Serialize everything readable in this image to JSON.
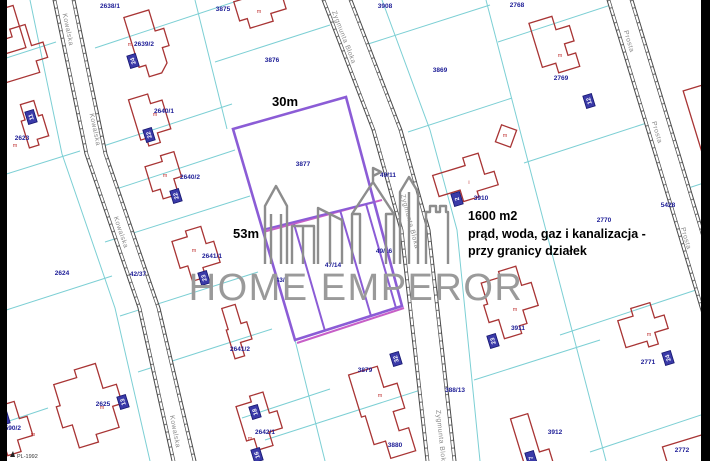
{
  "title": "Cadastral map - plot offer",
  "colors": {
    "parcel_line": "#7ccfd4",
    "building": "#a83434",
    "parcel_number": "#1c1c96",
    "plot_outline": "#8b5cd6",
    "plot_inner_magenta": "#c75fc7",
    "road_line": "#4a4a4a",
    "watermark": "#9a9a9a",
    "plate_fill": "#3a3aa8",
    "frame_bar": "#010101"
  },
  "watermark": {
    "text": "HOME EMPEROR"
  },
  "annotations": {
    "width_label": "30m",
    "height_label": "53m",
    "info_lines": [
      "1600 m2",
      "prąd, woda, gaz i kanalizacja -",
      "przy granicy działek"
    ]
  },
  "legend": {
    "text": "PL-1992"
  },
  "streets": [
    {
      "name": "Kowalska",
      "labels": [
        [
          66,
          30,
          78
        ],
        [
          93,
          130,
          78
        ],
        [
          119,
          233,
          71
        ],
        [
          173,
          432,
          79
        ]
      ]
    },
    {
      "name": "Zygmunta Bloka",
      "labels": [
        [
          342,
          38,
          69
        ],
        [
          408,
          222,
          75
        ],
        [
          439,
          438,
          84
        ]
      ]
    },
    {
      "name": "Prosta",
      "labels": [
        [
          627,
          42,
          73
        ],
        [
          655,
          133,
          73
        ],
        [
          684,
          239,
          73
        ]
      ]
    }
  ],
  "parcel_labels": [
    [
      "2638/1",
      110,
      8
    ],
    [
      "3875",
      223,
      11
    ],
    [
      "3908",
      385,
      8
    ],
    [
      "2768",
      517,
      7
    ],
    [
      "2639/2",
      144,
      46
    ],
    [
      "3876",
      272,
      62
    ],
    [
      "3869",
      440,
      72
    ],
    [
      "2769",
      561,
      80
    ],
    [
      "2640/1",
      164,
      113
    ],
    [
      "2623",
      22,
      140
    ],
    [
      "3877",
      303,
      166
    ],
    [
      "49/11",
      388,
      177
    ],
    [
      "2640/2",
      190,
      179
    ],
    [
      "3910",
      481,
      200
    ],
    [
      "5428",
      668,
      207
    ],
    [
      "2770",
      604,
      222
    ],
    [
      "2641/1",
      212,
      258
    ],
    [
      "2624",
      62,
      275
    ],
    [
      "42/37",
      138,
      276
    ],
    [
      "47/14",
      333,
      267
    ],
    [
      "49/16",
      384,
      253
    ],
    [
      "43/1",
      282,
      282
    ],
    [
      "2641/2",
      240,
      351
    ],
    [
      "3911",
      518,
      330
    ],
    [
      "2771",
      648,
      364
    ],
    [
      "3879",
      365,
      372
    ],
    [
      "388/13",
      455,
      392
    ],
    [
      "2625",
      103,
      406
    ],
    [
      "2590/2",
      11,
      430
    ],
    [
      "2642/1",
      265,
      434
    ],
    [
      "3880",
      395,
      447
    ],
    [
      "3912",
      555,
      434
    ],
    [
      "2772",
      682,
      452
    ]
  ],
  "address_plates": [
    [
      "24",
      133,
      61
    ],
    [
      "22",
      149,
      135
    ],
    [
      "11",
      31,
      117
    ],
    [
      "22",
      176,
      196
    ],
    [
      "23",
      204,
      278
    ],
    [
      "13",
      123,
      402
    ],
    [
      "9",
      4,
      418
    ],
    [
      "18",
      255,
      412
    ],
    [
      "16",
      257,
      455
    ],
    [
      "32",
      396,
      359
    ],
    [
      "23",
      493,
      341
    ],
    [
      "24",
      668,
      358
    ],
    [
      "12",
      589,
      101
    ],
    [
      "2",
      457,
      199
    ],
    [
      "7",
      531,
      458
    ]
  ],
  "building_letters": [
    [
      "m",
      130,
      46
    ],
    [
      "m",
      155,
      116
    ],
    [
      "m",
      165,
      177
    ],
    [
      "m",
      194,
      252
    ],
    [
      "m",
      250,
      440
    ],
    [
      "m",
      102,
      409
    ],
    [
      "m",
      33,
      436
    ],
    [
      "m",
      259,
      13
    ],
    [
      "m",
      560,
      57
    ],
    [
      "m",
      505,
      137
    ],
    [
      "m",
      649,
      336
    ],
    [
      "m",
      515,
      311
    ],
    [
      "m",
      380,
      397
    ],
    [
      "i",
      469,
      184
    ],
    [
      "m",
      15,
      147
    ]
  ],
  "buildings": [
    {
      "x": 148,
      "y": 52,
      "r": -17,
      "p": "M-13,-40 h26 v22 h9 v18 h-7 v16 l-8,8 h-13 v-12 h-7 v-24 z"
    },
    {
      "x": 30,
      "y": 68,
      "r": -17,
      "p": "M-30,-35 h22 v-8 h16 v22 h12 v16 h-12 v12 h-38 z"
    },
    {
      "x": 152,
      "y": 122,
      "r": -17,
      "p": "M-16,-28 h20 v10 h12 v30 h-14 v10 h-12 v-8 h-6 z"
    },
    {
      "x": 36,
      "y": 125,
      "r": -17,
      "p": "M-9,-24 h14 v16 h4 v22 h-12 v6 h-10 v-28 h4 z"
    },
    {
      "x": 170,
      "y": 180,
      "r": -17,
      "p": "M-20,-20 h18 v-6 h14 v26 h-8 v16 h-16 v-10 h-8 z"
    },
    {
      "x": 200,
      "y": 258,
      "r": -17,
      "p": "M-22,-24 h16 v-6 h16 v18 h8 v22 h-18 v10 h-14 v-16 h-8 z"
    },
    {
      "x": 237,
      "y": 331,
      "r": -17,
      "p": "M-8,-26 h14 v20 h6 v18 h-12 v14 h-10 v-30 h2 z"
    },
    {
      "x": 262,
      "y": 430,
      "r": -17,
      "p": "M-18,-30 h16 v-6 h14 v22 h8 v18 h-14 v14 h-16 v-12 h-8 v-22 z"
    },
    {
      "x": 100,
      "y": 406,
      "r": -17,
      "p": "M-38,-34 h24 v-8 h22 v26 h14 v20 h-10 v22 h-24 v8 h-20 v-24 h-10 v-22 h4 z"
    },
    {
      "x": 16,
      "y": 428,
      "r": -17,
      "p": "M-14,-26 h20 v18 h8 v20 h-16 v12 h-14 v-30 h2 z"
    },
    {
      "x": 262,
      "y": 12,
      "r": -17,
      "p": "M-24,-18 h18 v-8 h20 v16 h10 v14 h-16 v8 h-24 v-10 h-8 z"
    },
    {
      "x": 558,
      "y": 50,
      "r": -17,
      "p": "M-20,-34 h24 v14 h14 v16 h-10 v12 h8 v14 h-22 v-10 h-14 v-24 z"
    },
    {
      "x": 506,
      "y": 136,
      "r": 20,
      "p": "M-8,-9 h16 v18 h-16 z"
    },
    {
      "x": 466,
      "y": 182,
      "r": -17,
      "p": "M-30,-16 h34 v-8 h16 v22 h10 v14 h-22 v6 h-16 v-12 h-22 z"
    },
    {
      "x": 704,
      "y": 118,
      "r": -17,
      "p": "M-12,-32 h24 v64 h-24 z"
    },
    {
      "x": 646,
      "y": 331,
      "r": -17,
      "p": "M-24,-18 h16 v-8 h20 v16 h10 v14 h-14 v12 h-10 v-6 h-22 z"
    },
    {
      "x": 516,
      "y": 308,
      "r": -17,
      "p": "M-26,-34 h20 v-6 h18 v20 h10 v24 h-16 v14 h-8 v8 h-18 v-20 h-10 v-18 h4 z"
    },
    {
      "x": 534,
      "y": 441,
      "r": -17,
      "p": "M-16,-28 h18 v40 h10 v20 h-28 z"
    },
    {
      "x": 687,
      "y": 452,
      "r": -17,
      "p": "M-22,-12 h44 v26 h-44 z"
    },
    {
      "x": 385,
      "y": 412,
      "r": -17,
      "p": "M-24,-46 h30 v22 h14 v26 h-12 v20 h10 v24 h-26 v-18 h-12 v-30 h-4 v-22 z"
    },
    {
      "x": 8,
      "y": 30,
      "r": -17,
      "p": "M-12,-22 h24 v44 h-24 z"
    }
  ],
  "boundaries": [
    [
      0,
      60,
      56,
      42
    ],
    [
      0,
      176,
      80,
      151
    ],
    [
      0,
      312,
      112,
      276
    ],
    [
      0,
      424,
      48,
      408
    ],
    [
      95,
      48,
      240,
      0
    ],
    [
      85,
      152,
      232,
      104
    ],
    [
      98,
      195,
      235,
      150
    ],
    [
      105,
      242,
      250,
      196
    ],
    [
      120,
      316,
      258,
      272
    ],
    [
      138,
      372,
      272,
      329
    ],
    [
      242,
      418,
      330,
      389
    ],
    [
      215,
      62,
      330,
      25
    ],
    [
      265,
      440,
      430,
      387
    ],
    [
      486,
      0,
      606,
      461
    ],
    [
      365,
      45,
      490,
      5
    ],
    [
      408,
      132,
      512,
      98
    ],
    [
      498,
      42,
      626,
      0
    ],
    [
      524,
      163,
      662,
      118
    ],
    [
      560,
      335,
      702,
      288
    ],
    [
      474,
      380,
      600,
      340
    ],
    [
      590,
      452,
      710,
      412
    ],
    [
      676,
      192,
      710,
      181
    ]
  ],
  "boundary_polylines": [
    [
      [
        30,
        0
      ],
      [
        62,
        154
      ],
      [
        115,
        308
      ],
      [
        150,
        461
      ]
    ],
    [
      [
        195,
        0
      ],
      [
        227,
        129
      ]
    ],
    [
      [
        295,
        340
      ],
      [
        325,
        461
      ]
    ],
    [
      [
        382,
        0
      ],
      [
        430,
        130
      ],
      [
        457,
        230
      ],
      [
        480,
        461
      ]
    ]
  ],
  "roads": [
    {
      "fill": [
        [
          53,
          0
        ],
        [
          85,
          154
        ],
        [
          138,
          308
        ],
        [
          172,
          461
        ],
        [
          196,
          461
        ],
        [
          160,
          308
        ],
        [
          107,
          154
        ],
        [
          75,
          0
        ]
      ],
      "edges": [
        [
          [
            53,
            0
          ],
          [
            85,
            154
          ],
          [
            138,
            308
          ],
          [
            172,
            461
          ]
        ],
        [
          [
            56,
            0
          ],
          [
            88,
            154
          ],
          [
            141,
            308
          ],
          [
            175,
            461
          ]
        ],
        [
          [
            75,
            0
          ],
          [
            107,
            154
          ],
          [
            160,
            308
          ],
          [
            196,
            461
          ]
        ],
        [
          [
            72,
            0
          ],
          [
            104,
            154
          ],
          [
            157,
            308
          ],
          [
            193,
            461
          ]
        ]
      ],
      "ticks": [
        [
          [
            54.5,
            0
          ],
          [
            86.5,
            154
          ],
          [
            139.5,
            308
          ],
          [
            173.5,
            461
          ]
        ],
        [
          [
            73.5,
            0
          ],
          [
            105.5,
            154
          ],
          [
            158.5,
            308
          ],
          [
            194.5,
            461
          ]
        ]
      ]
    },
    {
      "fill": [
        [
          322,
          0
        ],
        [
          372,
          130
        ],
        [
          400,
          230
        ],
        [
          426,
          461
        ],
        [
          456,
          461
        ],
        [
          430,
          230
        ],
        [
          402,
          130
        ],
        [
          352,
          0
        ]
      ],
      "edges": [
        [
          [
            322,
            0
          ],
          [
            372,
            130
          ],
          [
            400,
            230
          ],
          [
            426,
            461
          ]
        ],
        [
          [
            325,
            0
          ],
          [
            375,
            130
          ],
          [
            403,
            230
          ],
          [
            429,
            461
          ]
        ],
        [
          [
            352,
            0
          ],
          [
            402,
            130
          ],
          [
            430,
            230
          ],
          [
            456,
            461
          ]
        ],
        [
          [
            349,
            0
          ],
          [
            399,
            130
          ],
          [
            427,
            230
          ],
          [
            453,
            461
          ]
        ]
      ],
      "ticks": [
        [
          [
            323.5,
            0
          ],
          [
            373.5,
            130
          ],
          [
            401.5,
            230
          ],
          [
            427.5,
            461
          ]
        ],
        [
          [
            350.5,
            0
          ],
          [
            400.5,
            130
          ],
          [
            428.5,
            230
          ],
          [
            454.5,
            461
          ]
        ]
      ]
    },
    {
      "fill": [
        [
          607,
          0
        ],
        [
          654,
          154
        ],
        [
          700,
          307
        ],
        [
          745,
          461
        ],
        [
          771,
          461
        ],
        [
          726,
          307
        ],
        [
          680,
          154
        ],
        [
          633,
          0
        ]
      ],
      "edges": [
        [
          [
            607,
            0
          ],
          [
            654,
            154
          ],
          [
            700,
            307
          ],
          [
            745,
            461
          ]
        ],
        [
          [
            610,
            0
          ],
          [
            657,
            154
          ],
          [
            703,
            307
          ],
          [
            748,
            461
          ]
        ],
        [
          [
            633,
            0
          ],
          [
            680,
            154
          ],
          [
            726,
            307
          ],
          [
            771,
            461
          ]
        ],
        [
          [
            630,
            0
          ],
          [
            677,
            154
          ],
          [
            723,
            307
          ],
          [
            768,
            461
          ]
        ]
      ],
      "ticks": [
        [
          [
            608.5,
            0
          ],
          [
            655.5,
            154
          ],
          [
            701.5,
            307
          ],
          [
            746.5,
            461
          ]
        ],
        [
          [
            631.5,
            0
          ],
          [
            678.5,
            154
          ],
          [
            724.5,
            307
          ],
          [
            769.5,
            461
          ]
        ]
      ]
    }
  ],
  "featured_plot": {
    "outer": [
      [
        233,
        129
      ],
      [
        346,
        97
      ],
      [
        402,
        306
      ],
      [
        295,
        340
      ]
    ],
    "inner_purple": [
      [
        [
          262,
          230
        ],
        [
          374,
          202
        ]
      ],
      [
        [
          294,
          224
        ],
        [
          325,
          331
        ]
      ],
      [
        [
          340,
          210
        ],
        [
          371,
          316
        ]
      ],
      [
        [
          366,
          204
        ],
        [
          396,
          308
        ]
      ]
    ],
    "inner_magenta": [
      [
        [
          263,
          232
        ],
        [
          382,
          200
        ]
      ],
      [
        [
          297,
          343
        ],
        [
          404,
          308
        ]
      ]
    ]
  },
  "logo_paths": [
    "M265,264 V206 L276,186 L287,206 V264 M271,264 V214 M281,264 V214",
    "M292,264 V226 H314 V264 M303,264 V226",
    "M318,264 V208 L342,220 V264 M330,264 V214",
    "M352,264 V214 H360 V264 M386,264 V214 H394 V264 M352,214 L373,182 L394,214 M373,182 V168 L381,172 L373,176",
    "M400,264 V192 L409,177 L418,192 V264 M409,264 V192",
    "M426,264 V212 H430 V206 H436 V212 H440 V206 H446 V212 H448 V264"
  ]
}
